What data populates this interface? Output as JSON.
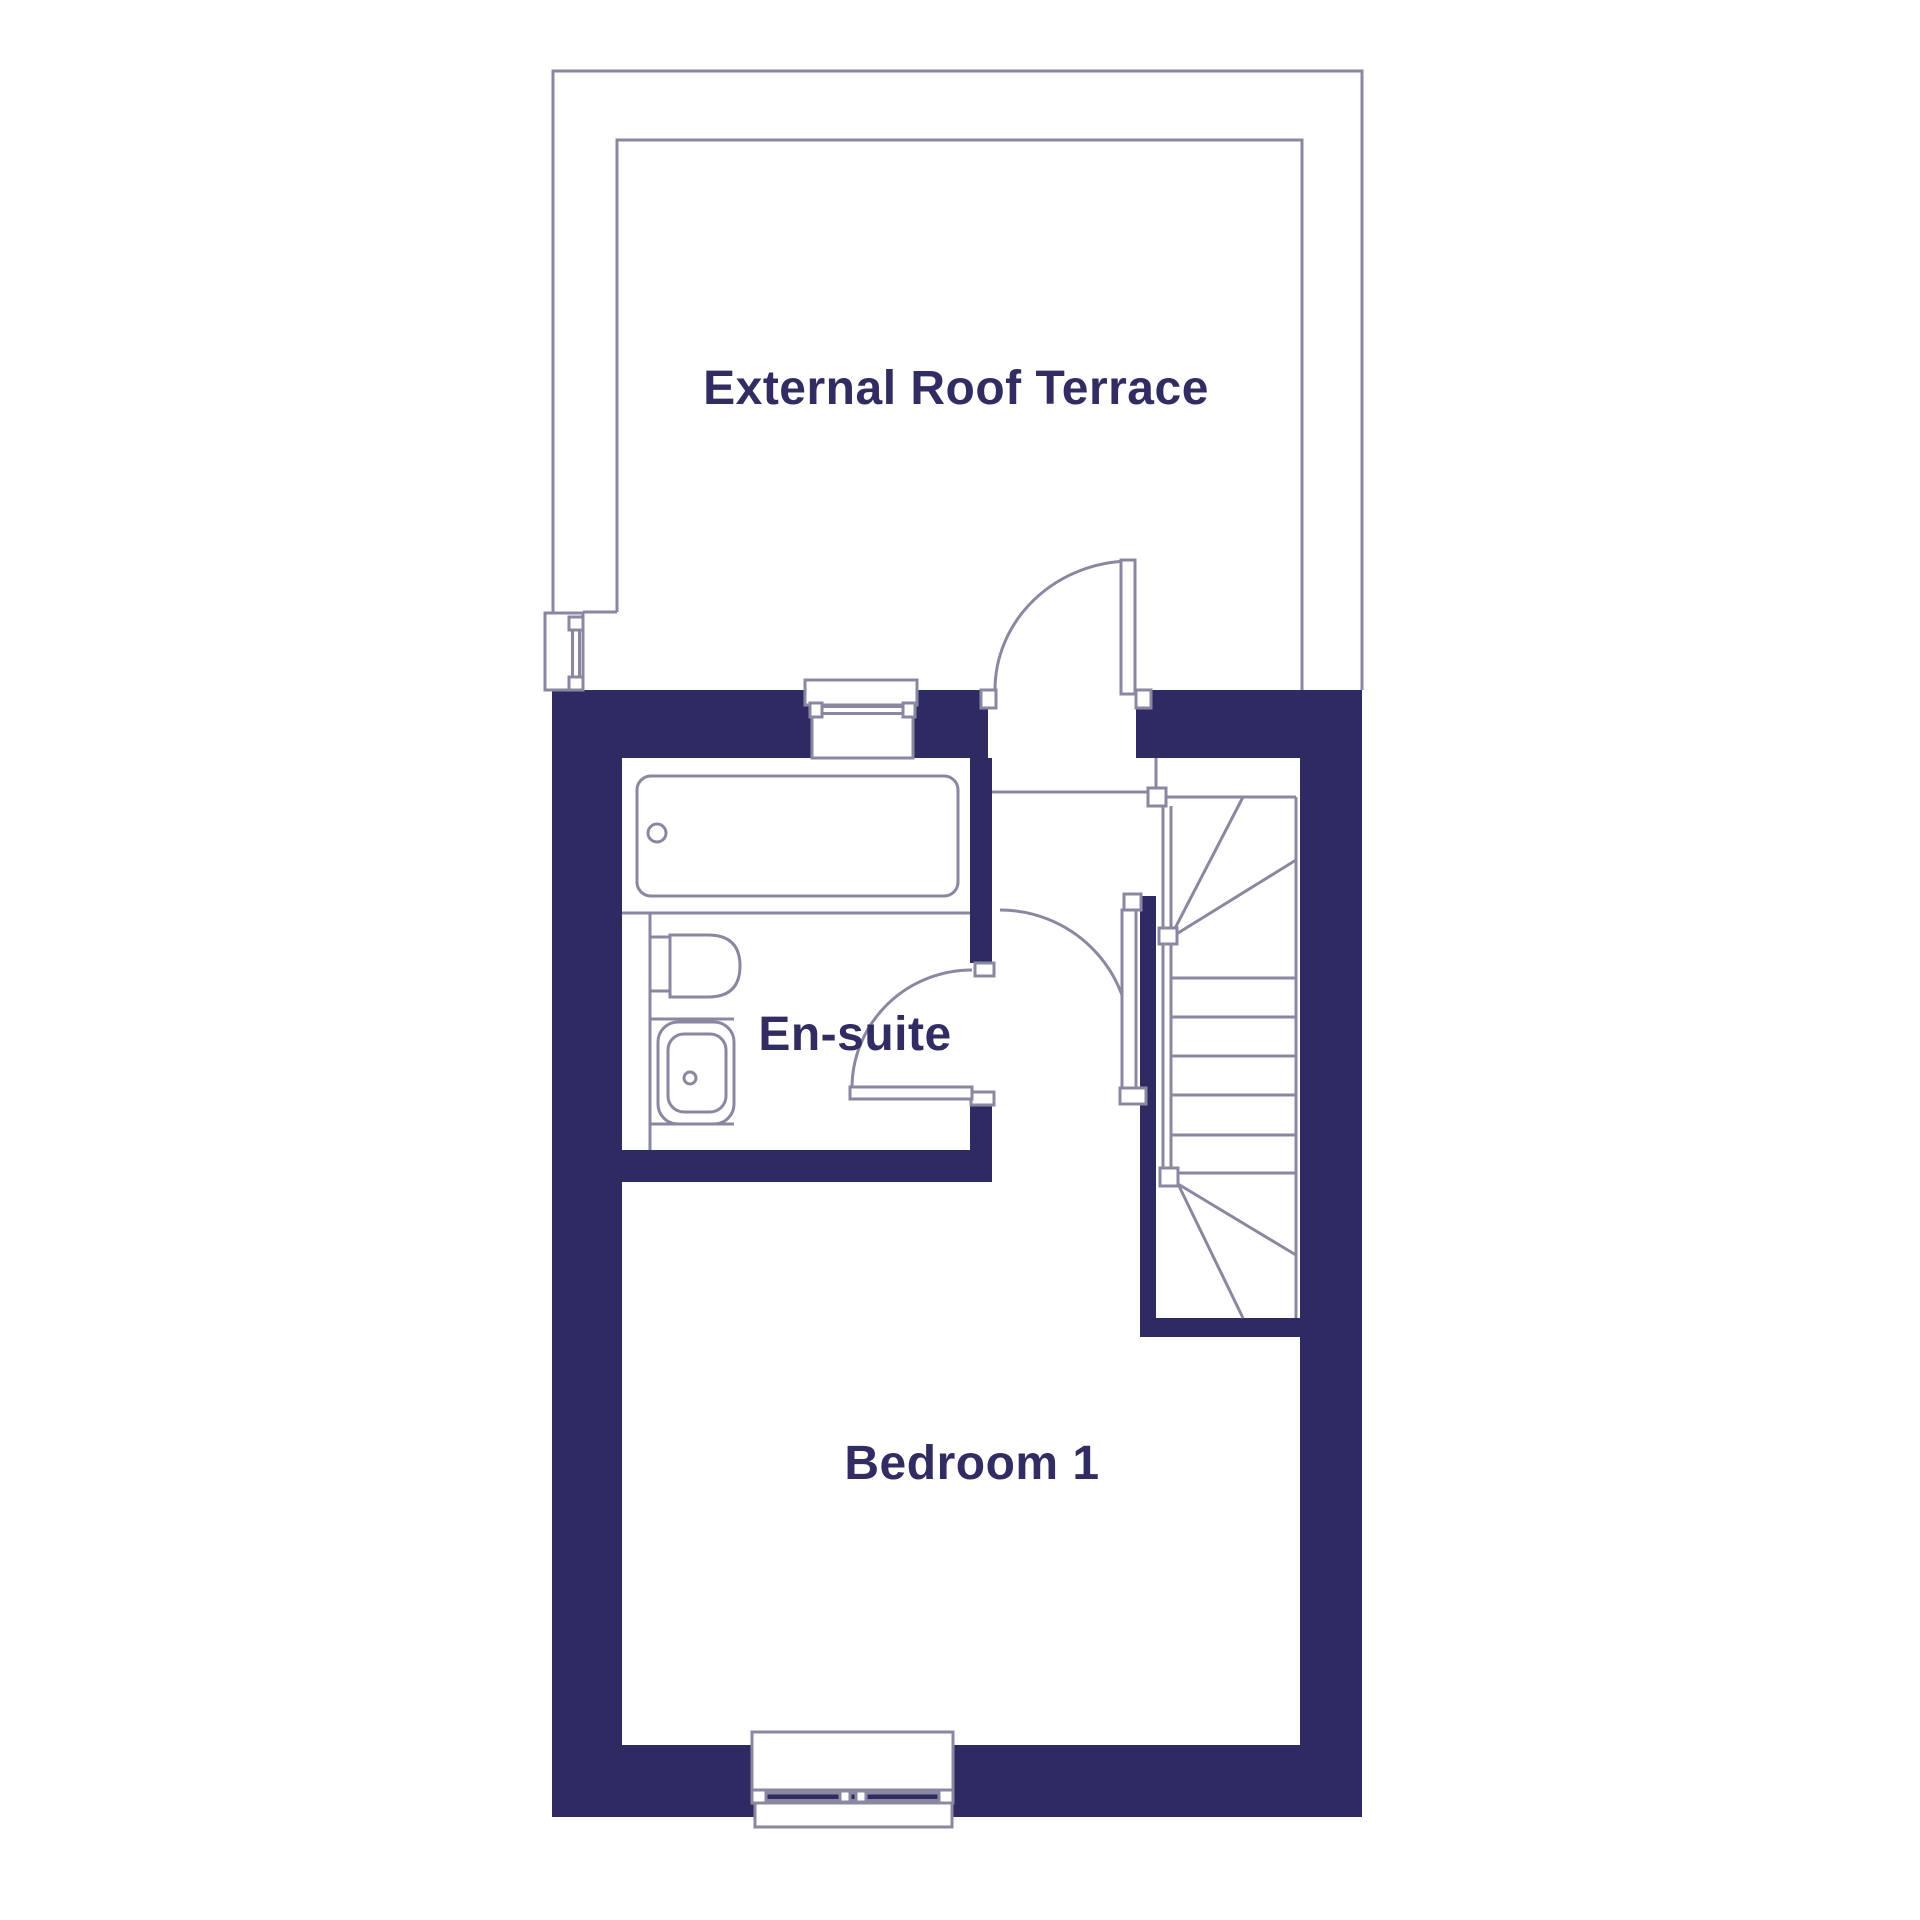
{
  "plan": {
    "type": "floor-plan",
    "rooms": [
      {
        "id": "terrace",
        "label": "External Roof Terrace"
      },
      {
        "id": "ensuite",
        "label": "En-suite"
      },
      {
        "id": "bedroom",
        "label": "Bedroom 1"
      }
    ]
  },
  "rooms": {
    "terrace": {
      "label": "External Roof Terrace"
    },
    "ensuite": {
      "label": "En-suite"
    },
    "bedroom": {
      "label": "Bedroom 1"
    }
  },
  "fixtures": {
    "bath": "bath",
    "toilet": "toilet",
    "basin": "basin",
    "staircase": "winder-staircase",
    "door_count": 3,
    "window_count": 3
  },
  "colors": {
    "wall": "#2e2b63",
    "line": "#8a88a0",
    "text": "#312d63",
    "bg": "#ffffff"
  }
}
